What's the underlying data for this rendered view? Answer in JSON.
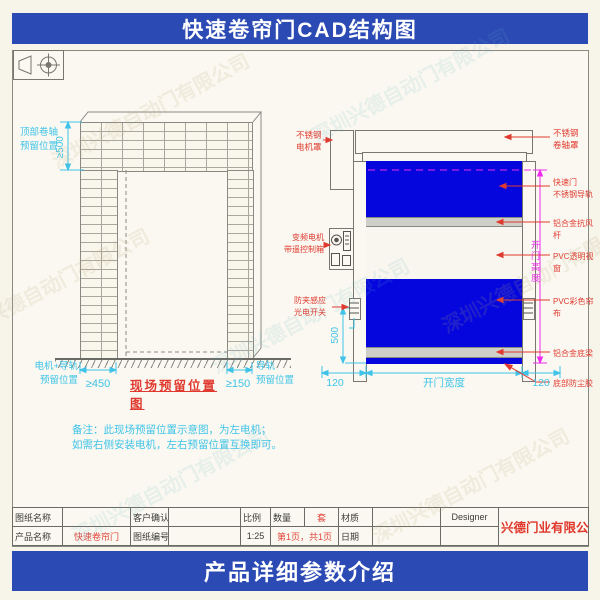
{
  "banners": {
    "top": "快速卷帘门CAD结构图",
    "bottom": "产品详细参数介绍"
  },
  "watermark": {
    "text": "深圳兴德自动门有限公司"
  },
  "colors": {
    "banner_blue": "#2b4ab4",
    "curtain_blue": "#0406dd",
    "dim_cyan": "#3fc3e8",
    "label_red": "#e03a30",
    "magenta": "#ee2bee",
    "value_red": "#e0463c"
  },
  "left_view": {
    "roller_label": "顶部卷轴\n预留位置",
    "dim_top": "≥500",
    "motor_label": "电机+导轨\n预留位置",
    "dim_left": "≥450",
    "title": "现场预留位置图",
    "dim_right": "≥150",
    "rail_label": "导轨\n预留位置",
    "note1": "备注：此现场预留位置示意图，为左电机；",
    "note2": "如需右侧安装电机，左右预留位置互换即可。"
  },
  "right_view": {
    "labels_left": [
      "不锈钢\n电机罩",
      "变频电机\n带遥控制箱",
      "防夹感应\n光电开关"
    ],
    "labels_right": [
      "不锈钢\n卷轴罩",
      "快速门\n不锈钢导轨",
      "铝合金抗风杆",
      "PVC透明视窗",
      "PVC彩色帘布",
      "铝合金底梁",
      "底部防尘胶"
    ],
    "dim_side": "500",
    "dim_bottom_left": "120",
    "dim_bottom_center": "开门宽度",
    "dim_bottom_right": "120",
    "dim_height": "开门高度"
  },
  "title_block": {
    "r1c1": "图纸名称",
    "r1c2": "",
    "r1c3": "客户确认",
    "r1c4": "",
    "r1c5": "比例",
    "r1c6": "数量",
    "r1c7": "套",
    "r1c8": "材质",
    "r1c9": "",
    "r1c10": "Designer",
    "r2c1": "产品名称",
    "r2c2": "快速卷帘门",
    "r2c3": "图纸编号",
    "r2c4": "",
    "r2c5": "1:25",
    "r2c6": "第1页，共1页",
    "r2c7": "日期",
    "r2c8": "",
    "r2c9": "",
    "company": "兴德门业有限公司"
  }
}
